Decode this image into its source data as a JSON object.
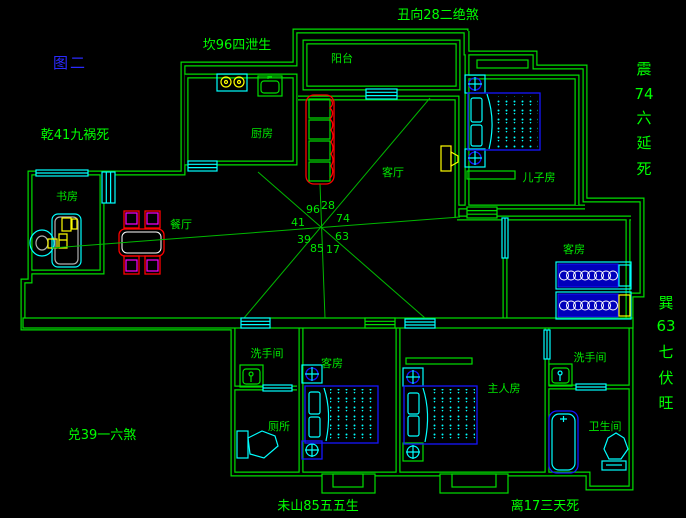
{
  "title": {
    "label": "图二"
  },
  "palette": {
    "background": "#000000",
    "wall_green": "#00DE00",
    "text_green": "#00FF00",
    "ray_green": "#00B800",
    "cyan": "#00FFFF",
    "blue": "#1515FF",
    "navy_fill": "#0000BB",
    "yellow": "#FFFF00",
    "red": "#FF0000",
    "magenta": "#FF00FF",
    "gray": "#B0B0B0",
    "title_blue": "#2A2AFF"
  },
  "annotations": {
    "top_left": "坎96四泄生",
    "top_center": "丑向28二绝煞",
    "left": "乾41九祸死",
    "bottom_left": "兑39一六煞",
    "bottom_center": "未山85五五生",
    "bottom_right": "离17三天死",
    "right_upper": [
      "震",
      "74",
      "六",
      "延",
      "死"
    ],
    "right_lower": [
      "巽",
      "63",
      "七",
      "伏",
      "旺"
    ]
  },
  "compass": {
    "nnw": "96",
    "nne": "28",
    "ene": "74",
    "ese": "63",
    "sse": "17",
    "ssw": "85",
    "wsw": "39",
    "wnw": "41"
  },
  "rooms": {
    "balcony": "阳台",
    "kitchen": "厨房",
    "living": "客厅",
    "son": "儿子房",
    "study": "书房",
    "dining": "餐厅",
    "guest_right": "客房",
    "guest_bottom": "客房",
    "wash_left": "洗手间",
    "toilet": "厕所",
    "master": "主人房",
    "wash_right": "洗手间",
    "bathroom": "卫生间"
  }
}
